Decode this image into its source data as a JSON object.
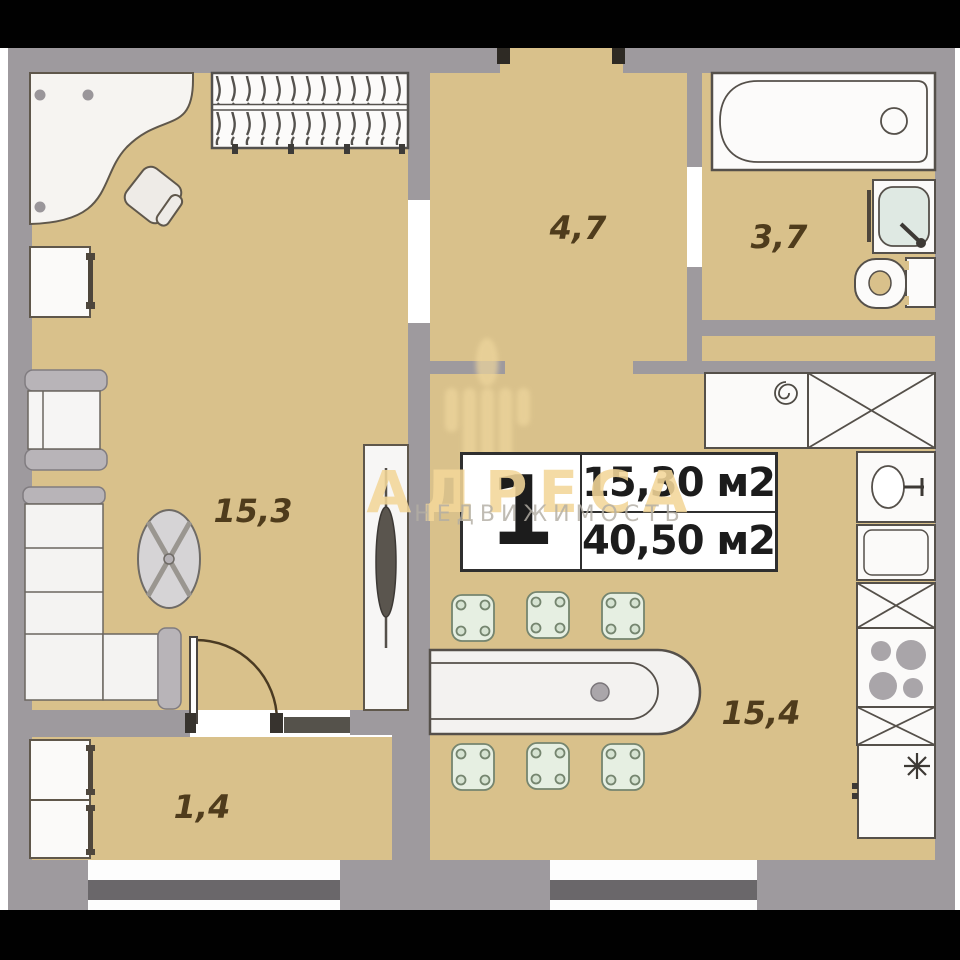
{
  "floorplan": {
    "unit": {
      "number": "1",
      "living_area": "15,30 м2",
      "total_area": "40,50 м2"
    },
    "rooms": [
      {
        "name": "hallway",
        "area_label": "4,7"
      },
      {
        "name": "bathroom",
        "area_label": "3,7"
      },
      {
        "name": "living-room",
        "area_label": "15,3"
      },
      {
        "name": "kitchen-living",
        "area_label": "15,4"
      },
      {
        "name": "balcony",
        "area_label": "1,4"
      }
    ],
    "watermark": {
      "brand": "АДРЕСА",
      "tagline": "НЕДВИЖИМОСТЬ"
    },
    "colors": {
      "floor": "#d9c18b",
      "wall": "#9e9a9e",
      "watermark_gold": "#f2d698",
      "stool_green": "#e6efe2"
    }
  }
}
